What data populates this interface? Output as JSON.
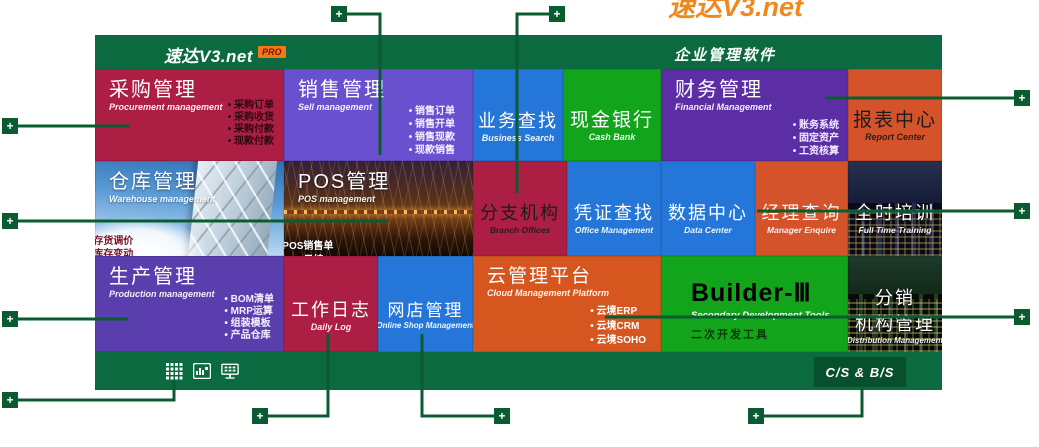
{
  "header": {
    "logo": "速达V3.net",
    "pro_badge": "PRO",
    "product_title": "企业管理软件",
    "clipped_top_text": "速达V3.net"
  },
  "tiles": {
    "procurement": {
      "title": "采购管理",
      "subtitle": "Procurement management",
      "bullets": [
        "采购订单",
        "采购收货",
        "采购付款",
        "现款付款"
      ]
    },
    "sales": {
      "title": "销售管理",
      "subtitle": "Sell management",
      "bullets": [
        "销售订单",
        "销售开单",
        "销售现款",
        "现款销售"
      ]
    },
    "business_search": {
      "title": "业务查找",
      "subtitle": "Business Search"
    },
    "cash_bank": {
      "title": "现金银行",
      "subtitle": "Cash Bank"
    },
    "finance": {
      "title": "财务管理",
      "subtitle": "Financial Management",
      "bullets": [
        "账务系统",
        "固定资产",
        "工资核算"
      ]
    },
    "report_center": {
      "title": "报表中心",
      "subtitle": "Report Center"
    },
    "warehouse": {
      "title": "仓库管理",
      "subtitle": "Warehouse management",
      "bullets": [
        "存货调价",
        "库存变动",
        "库存盘点",
        "库存调拨"
      ]
    },
    "pos": {
      "title": "POS管理",
      "subtitle": "POS management",
      "bullets": [
        "POS销售单",
        "POS日结",
        "积分调整",
        "积分兑现"
      ]
    },
    "branch_offices": {
      "title": "分支机构",
      "subtitle": "Branch Offices"
    },
    "voucher_search": {
      "title": "凭证查找",
      "subtitle": "Office Management"
    },
    "data_center": {
      "title": "数据中心",
      "subtitle": "Data Center"
    },
    "manager_enquire": {
      "title": "经理查询",
      "subtitle": "Manager Enquire"
    },
    "full_time_training": {
      "title": "全时培训",
      "subtitle": "Full Time Training"
    },
    "production": {
      "title": "生产管理",
      "subtitle": "Production management",
      "bullets": [
        "BOM清单",
        "MRP运算",
        "组装模板",
        "产品仓库"
      ]
    },
    "daily_log": {
      "title": "工作日志",
      "subtitle": "Daily Log"
    },
    "online_shop": {
      "title": "网店管理",
      "subtitle": "Online Shop Management"
    },
    "cloud_platform": {
      "title": "云管理平台",
      "subtitle": "Cloud Management Platform",
      "bullets": [
        "云境ERP",
        "云境CRM",
        "云境SOHO"
      ]
    },
    "builder": {
      "title": "Builder-Ⅲ",
      "subtitle": "Secondary Development Tools",
      "subtitle_cn": "二次开发工具"
    },
    "distribution": {
      "title_line1": "分销",
      "title_line2": "机构管理",
      "subtitle": "Distribution Management"
    }
  },
  "footer": {
    "icons": [
      "app-grid-icon",
      "report-chart-icon",
      "network-monitor-icon"
    ],
    "badge": "C/S & B/S"
  },
  "callout": {
    "plus": "+"
  },
  "colors": {
    "bar_green": "#0b6a3f",
    "callout_green": "#0a5c30",
    "crimson": "#ad1e45",
    "purple": "#6950ce",
    "violet": "#5c2ea6",
    "blue": "#2476d9",
    "green": "#12a41b",
    "orange_red": "#d4532a",
    "orange": "#d5571f",
    "indigo": "#5b3eae",
    "logo_orange": "#f0881e"
  }
}
